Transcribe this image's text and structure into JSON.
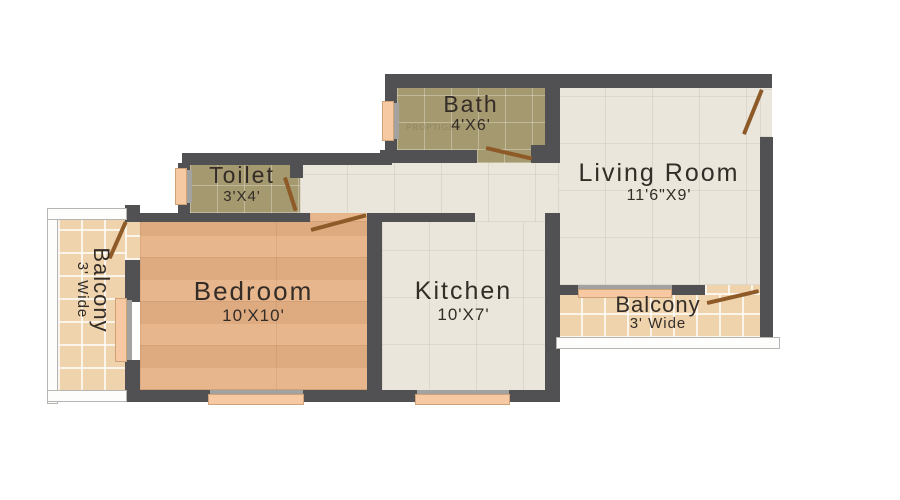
{
  "plan": {
    "watermark": "PROPTIGER",
    "rooms": {
      "bath": {
        "name": "Bath",
        "dims": "4'X6'"
      },
      "toilet": {
        "name": "Toilet",
        "dims": "3'X4'"
      },
      "living_room": {
        "name": "Living Room",
        "dims": "11'6\"X9'"
      },
      "bedroom": {
        "name": "Bedroom",
        "dims": "10'X10'"
      },
      "kitchen": {
        "name": "Kitchen",
        "dims": "10'X7'"
      },
      "balcony_left": {
        "name": "Balcony",
        "dims": "3' Wide"
      },
      "balcony_right": {
        "name": "Balcony",
        "dims": "3' Wide"
      }
    },
    "colors": {
      "wall": "#515153",
      "floor_beige": "#eae6db",
      "floor_khaki": "#a59970",
      "floor_wood": "#e7b285",
      "floor_tan": "#eed3ac",
      "window": "#f7c9a2",
      "door": "#8d5a28",
      "railing": "#fdfdfc",
      "text": "#332c27"
    }
  }
}
